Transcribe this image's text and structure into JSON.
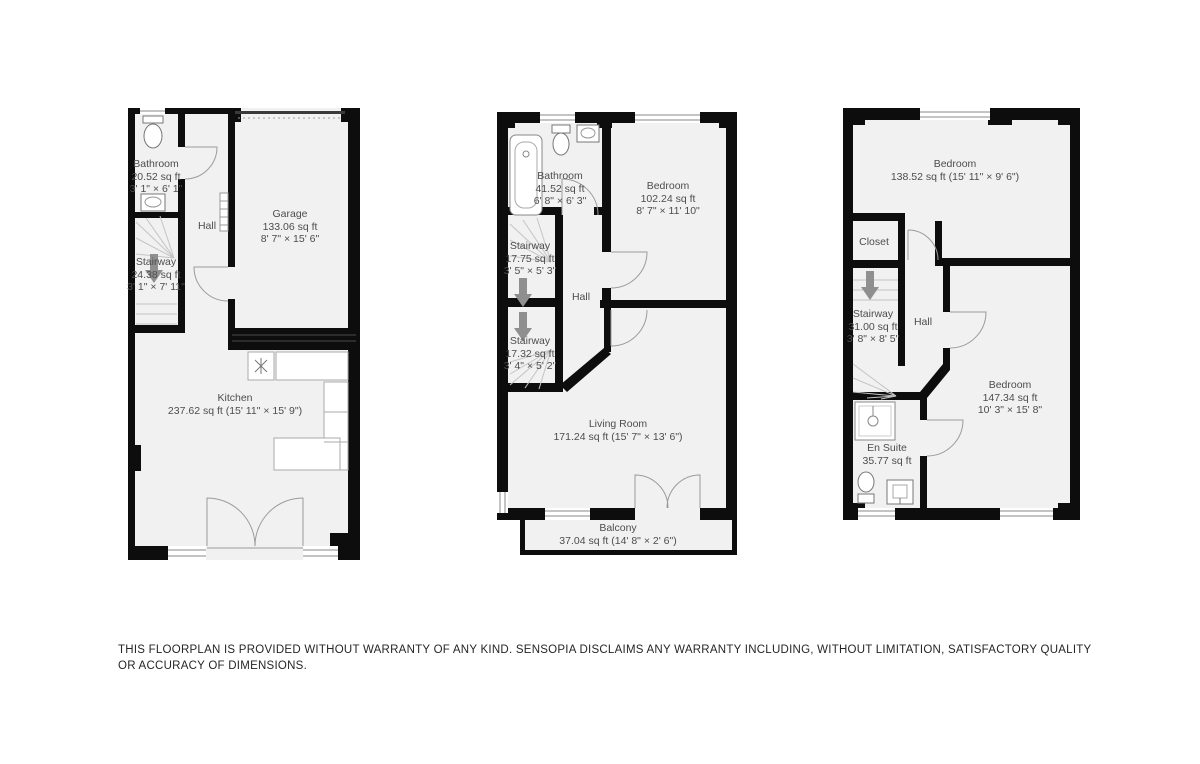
{
  "disclaimer": "THIS FLOORPLAN IS PROVIDED WITHOUT WARRANTY OF ANY KIND. SENSOPIA DISCLAIMS ANY WARRANTY INCLUDING, WITHOUT LIMITATION, SATISFACTORY QUALITY OR ACCURACY OF DIMENSIONS.",
  "floor1": {
    "bathroom": {
      "name": "Bathroom",
      "area": "20.52 sq ft",
      "dims": "3' 1\" × 6' 1\""
    },
    "stairway": {
      "name": "Stairway",
      "area": "24.38 sq ft",
      "dims": "3' 1\" × 7' 11\""
    },
    "hall": {
      "name": "Hall"
    },
    "garage": {
      "name": "Garage",
      "area": "133.06 sq ft",
      "dims": "8' 7\" × 15' 6\""
    },
    "kitchen": {
      "name": "Kitchen",
      "area": "237.62 sq ft (15' 11\" × 15' 9\")"
    }
  },
  "floor2": {
    "bathroom": {
      "name": "Bathroom",
      "area": "41.52 sq ft",
      "dims": "6' 8\" × 6' 3\""
    },
    "bedroom": {
      "name": "Bedroom",
      "area": "102.24 sq ft",
      "dims": "8' 7\" × 11' 10\""
    },
    "stairway_upper": {
      "name": "Stairway",
      "area": "17.75 sq ft",
      "dims": "3' 5\" × 5' 3\""
    },
    "stairway_lower": {
      "name": "Stairway",
      "area": "17.32 sq ft",
      "dims": "3' 4\" × 5' 2\""
    },
    "hall": {
      "name": "Hall"
    },
    "living_room": {
      "name": "Living Room",
      "area": "171.24 sq ft (15' 7\" × 13' 6\")"
    },
    "balcony": {
      "name": "Balcony",
      "area": "37.04 sq ft (14' 8\" × 2' 6\")"
    }
  },
  "floor3": {
    "bedroom_top": {
      "name": "Bedroom",
      "area": "138.52 sq ft (15' 11\" × 9' 6\")"
    },
    "closet": {
      "name": "Closet"
    },
    "stairway": {
      "name": "Stairway",
      "area": "31.00 sq ft",
      "dims": "3' 8\" × 8' 5\""
    },
    "hall": {
      "name": "Hall"
    },
    "bedroom_right": {
      "name": "Bedroom",
      "area": "147.34 sq ft",
      "dims": "10' 3\" × 15' 8\""
    },
    "ensuite": {
      "name": "En Suite",
      "area": "35.77 sq ft"
    }
  }
}
